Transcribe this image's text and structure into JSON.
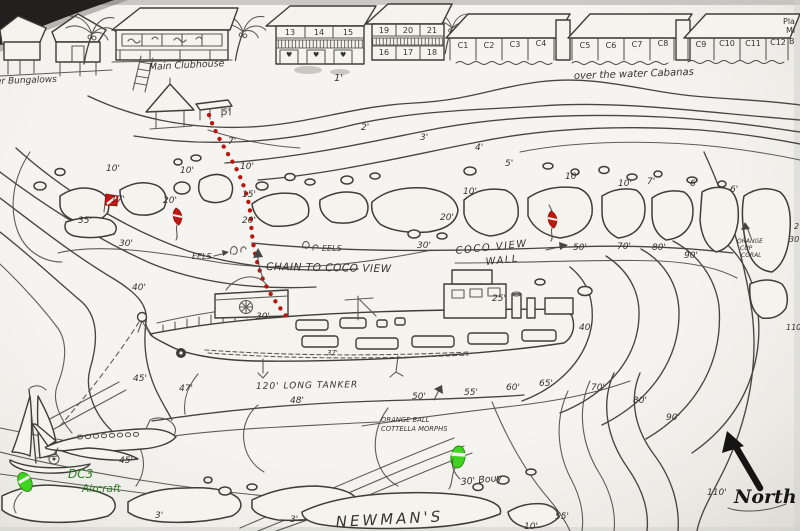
{
  "colors": {
    "ink": "#46453f",
    "red": "#bb1510",
    "green": "#3fd41f",
    "paper": "#f4f3ee",
    "dc3_text": "#2e7d22"
  },
  "resort": {
    "bungalows_label": "er Bungalows",
    "clubhouse_label": "Main Clubhouse",
    "cabanas_label": "over the water Cabanas",
    "corner_labels": [
      {
        "text": "Pla",
        "x": 783,
        "y": 24,
        "size": 8
      },
      {
        "text": "Mi",
        "x": 786,
        "y": 33,
        "size": 8
      },
      {
        "text": "B",
        "x": 789,
        "y": 44,
        "size": 8
      }
    ],
    "unit_numbers": [
      {
        "text": "13",
        "x": 290,
        "y": 35,
        "anchor": "middle",
        "size": 8
      },
      {
        "text": "14",
        "x": 319,
        "y": 35,
        "anchor": "middle",
        "size": 8
      },
      {
        "text": "15",
        "x": 348,
        "y": 35,
        "anchor": "middle",
        "size": 8
      },
      {
        "text": "19",
        "x": 384,
        "y": 33,
        "anchor": "middle",
        "size": 8
      },
      {
        "text": "20",
        "x": 408,
        "y": 33,
        "anchor": "middle",
        "size": 8
      },
      {
        "text": "21",
        "x": 432,
        "y": 33,
        "anchor": "middle",
        "size": 8
      },
      {
        "text": "16",
        "x": 384,
        "y": 55,
        "anchor": "middle",
        "size": 8
      },
      {
        "text": "17",
        "x": 408,
        "y": 55,
        "anchor": "middle",
        "size": 8
      },
      {
        "text": "18",
        "x": 432,
        "y": 55,
        "anchor": "middle",
        "size": 8
      }
    ],
    "cabana_numbers": [
      {
        "text": "C1",
        "x": 463,
        "y": 48,
        "anchor": "middle",
        "size": 8
      },
      {
        "text": "C2",
        "x": 489,
        "y": 48,
        "anchor": "middle",
        "size": 8
      },
      {
        "text": "C3",
        "x": 515,
        "y": 47,
        "anchor": "middle",
        "size": 8
      },
      {
        "text": "C4",
        "x": 541,
        "y": 46,
        "anchor": "middle",
        "size": 8
      },
      {
        "text": "C5",
        "x": 585,
        "y": 48,
        "anchor": "middle",
        "size": 8
      },
      {
        "text": "C6",
        "x": 611,
        "y": 48,
        "anchor": "middle",
        "size": 8
      },
      {
        "text": "C7",
        "x": 637,
        "y": 47,
        "anchor": "middle",
        "size": 8
      },
      {
        "text": "C8",
        "x": 663,
        "y": 46,
        "anchor": "middle",
        "size": 8
      },
      {
        "text": "C9",
        "x": 701,
        "y": 47,
        "anchor": "middle",
        "size": 8
      },
      {
        "text": "C10",
        "x": 727,
        "y": 46,
        "anchor": "middle",
        "size": 8
      },
      {
        "text": "C11",
        "x": 753,
        "y": 46,
        "anchor": "middle",
        "size": 8
      },
      {
        "text": "C12",
        "x": 778,
        "y": 45,
        "anchor": "middle",
        "size": 8
      }
    ]
  },
  "wreck": {
    "tanker_label": "120' LONG TANKER",
    "chain_label": "CHAIN TO COCO VIEW",
    "wall_line1": "COCO VIEW",
    "wall_line2": "WALL"
  },
  "site": {
    "newmans_label": "NEWMAN'S",
    "north_label": "North",
    "dc3_line1": "DC3",
    "dc3_line2": "Aircraft",
    "bouy_label": "30' Bouy"
  },
  "labels": {
    "features": [
      {
        "text": "EELS",
        "x": 192,
        "y": 259,
        "size": 8
      },
      {
        "text": "EELS",
        "x": 322,
        "y": 251,
        "size": 8
      },
      {
        "text": "ORANGE",
        "x": 737,
        "y": 243,
        "size": 6
      },
      {
        "text": "CUP",
        "x": 740,
        "y": 250,
        "size": 6
      },
      {
        "text": "CORAL",
        "x": 741,
        "y": 257,
        "size": 6
      },
      {
        "text": "ORANGE BALL",
        "x": 381,
        "y": 422,
        "size": 6.8
      },
      {
        "text": "COTTELLA MORPHS",
        "x": 381,
        "y": 431,
        "size": 6.8
      },
      {
        "text": "♥",
        "x": 286,
        "y": 57,
        "size": 7
      },
      {
        "text": "♥",
        "x": 313,
        "y": 57,
        "size": 7
      },
      {
        "text": "♥",
        "x": 340,
        "y": 57,
        "size": 7
      }
    ],
    "depths": [
      {
        "text": "1'",
        "x": 334,
        "y": 81,
        "size": 10
      },
      {
        "text": "2'",
        "x": 361,
        "y": 130
      },
      {
        "text": "3'",
        "x": 420,
        "y": 140
      },
      {
        "text": "4'",
        "x": 475,
        "y": 150
      },
      {
        "text": "5'",
        "x": 505,
        "y": 166
      },
      {
        "text": "5'",
        "x": 222,
        "y": 115
      },
      {
        "text": "7'",
        "x": 228,
        "y": 144
      },
      {
        "text": "10'",
        "x": 240,
        "y": 169
      },
      {
        "text": "15'",
        "x": 242,
        "y": 197
      },
      {
        "text": "20'",
        "x": 242,
        "y": 223
      },
      {
        "text": "10'",
        "x": 106,
        "y": 171
      },
      {
        "text": "10'",
        "x": 180,
        "y": 173
      },
      {
        "text": "17'",
        "x": 111,
        "y": 202
      },
      {
        "text": "20'",
        "x": 163,
        "y": 203
      },
      {
        "text": "35'",
        "x": 78,
        "y": 223
      },
      {
        "text": "30'",
        "x": 119,
        "y": 246
      },
      {
        "text": "30'",
        "x": 417,
        "y": 248
      },
      {
        "text": "50'",
        "x": 573,
        "y": 250
      },
      {
        "text": "70'",
        "x": 617,
        "y": 249
      },
      {
        "text": "80'",
        "x": 652,
        "y": 250
      },
      {
        "text": "90'",
        "x": 684,
        "y": 258
      },
      {
        "text": "10'",
        "x": 463,
        "y": 194
      },
      {
        "text": "20'",
        "x": 440,
        "y": 220
      },
      {
        "text": "10'",
        "x": 565,
        "y": 179
      },
      {
        "text": "10'",
        "x": 618,
        "y": 186
      },
      {
        "text": "7'",
        "x": 647,
        "y": 184
      },
      {
        "text": "6'",
        "x": 690,
        "y": 186
      },
      {
        "text": "6'",
        "x": 730,
        "y": 192
      },
      {
        "text": "2",
        "x": 794,
        "y": 229,
        "size": 8
      },
      {
        "text": "30",
        "x": 789,
        "y": 242,
        "size": 8
      },
      {
        "text": "30'",
        "x": 256,
        "y": 319
      },
      {
        "text": "37'",
        "x": 327,
        "y": 355,
        "size": 7
      },
      {
        "text": "25'",
        "x": 492,
        "y": 301
      },
      {
        "text": "40'",
        "x": 579,
        "y": 330
      },
      {
        "text": "40'",
        "x": 132,
        "y": 290
      },
      {
        "text": "45'",
        "x": 133,
        "y": 381
      },
      {
        "text": "47'",
        "x": 179,
        "y": 391
      },
      {
        "text": "48'",
        "x": 290,
        "y": 403
      },
      {
        "text": "50'",
        "x": 412,
        "y": 399
      },
      {
        "text": "55'",
        "x": 464,
        "y": 395
      },
      {
        "text": "60'",
        "x": 506,
        "y": 390
      },
      {
        "text": "65'",
        "x": 539,
        "y": 386
      },
      {
        "text": "70'",
        "x": 591,
        "y": 390
      },
      {
        "text": "80'",
        "x": 633,
        "y": 403
      },
      {
        "text": "90'",
        "x": 666,
        "y": 420
      },
      {
        "text": "110'",
        "x": 707,
        "y": 495
      },
      {
        "text": "110'",
        "x": 786,
        "y": 330,
        "size": 8
      },
      {
        "text": "45'",
        "x": 119,
        "y": 463
      },
      {
        "text": "3'",
        "x": 155,
        "y": 518
      },
      {
        "text": "3'",
        "x": 290,
        "y": 522
      },
      {
        "text": "55'",
        "x": 555,
        "y": 519
      },
      {
        "text": "10'",
        "x": 524,
        "y": 529
      }
    ]
  }
}
